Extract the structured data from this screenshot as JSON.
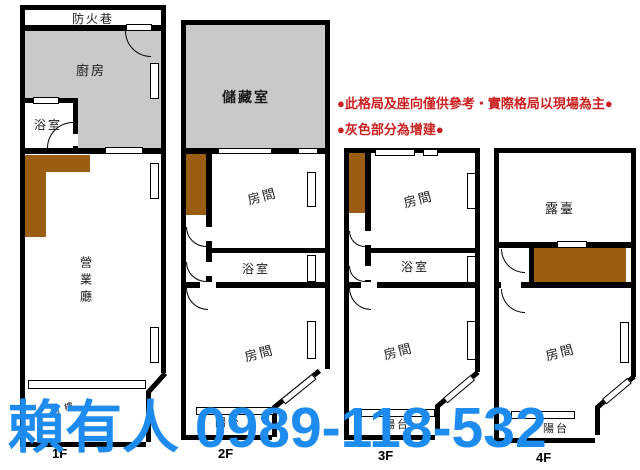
{
  "canvas": {
    "background": "#ffffff"
  },
  "watermark": {
    "text": "賴有人 0989-118-532",
    "color": "#1e8cee"
  },
  "notes": {
    "line1": "●此格局及座向僅供參考‧實際格局以現場為主●",
    "line2": "●灰色部分為增建●",
    "color": "#cb2020"
  },
  "legend_colors": {
    "addition_gray": "#c9c9c9",
    "addition_brown": "#9a5d12",
    "wall_black": "#000000"
  },
  "floors": [
    {
      "label": "1F",
      "rooms": {
        "fire_lane": "防火巷",
        "kitchen": "廚房",
        "bathroom": "浴室",
        "business_hall": "營業廳",
        "arcade": "騎樓"
      }
    },
    {
      "label": "2F",
      "rooms": {
        "storage": "儲藏室",
        "room_upper": "房間",
        "bathroom": "浴室",
        "room_lower": "房間",
        "balcony": "陽台"
      }
    },
    {
      "label": "3F",
      "rooms": {
        "room_upper": "房間",
        "bathroom": "浴室",
        "room_lower": "房間",
        "balcony": "陽台"
      }
    },
    {
      "label": "4F",
      "rooms": {
        "terrace": "露臺",
        "room": "房間",
        "balcony": "陽台"
      }
    }
  ]
}
